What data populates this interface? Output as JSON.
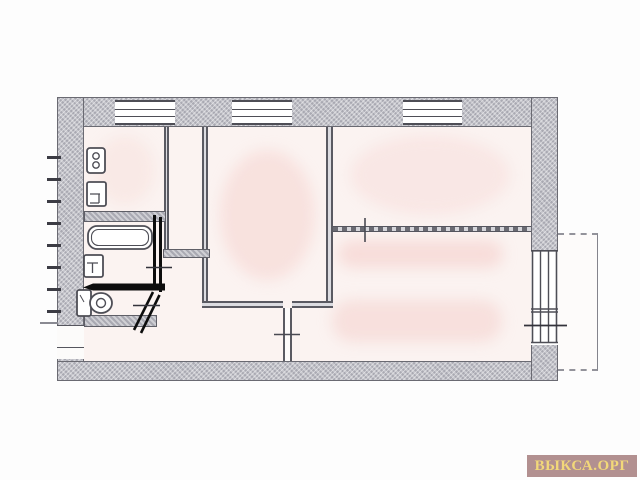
{
  "watermark": {
    "text": "ВЫКСА.ОРГ",
    "background": "#b29090",
    "color": "#f2d879"
  },
  "palette": {
    "wall_fill": "#b9b9c1",
    "wall_hatch_light": "#c6c6cc",
    "line_dark": "#55555e",
    "new_partition_black": "#0d0d0d",
    "floor_tint": "#fbf3f1",
    "scan_blob_tint": "#f5cfc8",
    "balcony_line": "#84848c",
    "background": "#fdfdfd"
  },
  "plan": {
    "type": "apartment-floor-plan-scan",
    "fixtures": [
      "gas-stove",
      "kitchen-sink",
      "bathtub",
      "wash-basin",
      "toilet"
    ],
    "features": [
      "three-windows-top-wall",
      "window-and-balcony-door-right-wall",
      "balcony-right",
      "entrance-door-left-wall",
      "black-new-partition-lines",
      "door-opening-cross-marks",
      "door-swing-diagonal-marks",
      "stair-tick-marks-left-of-wall"
    ]
  }
}
